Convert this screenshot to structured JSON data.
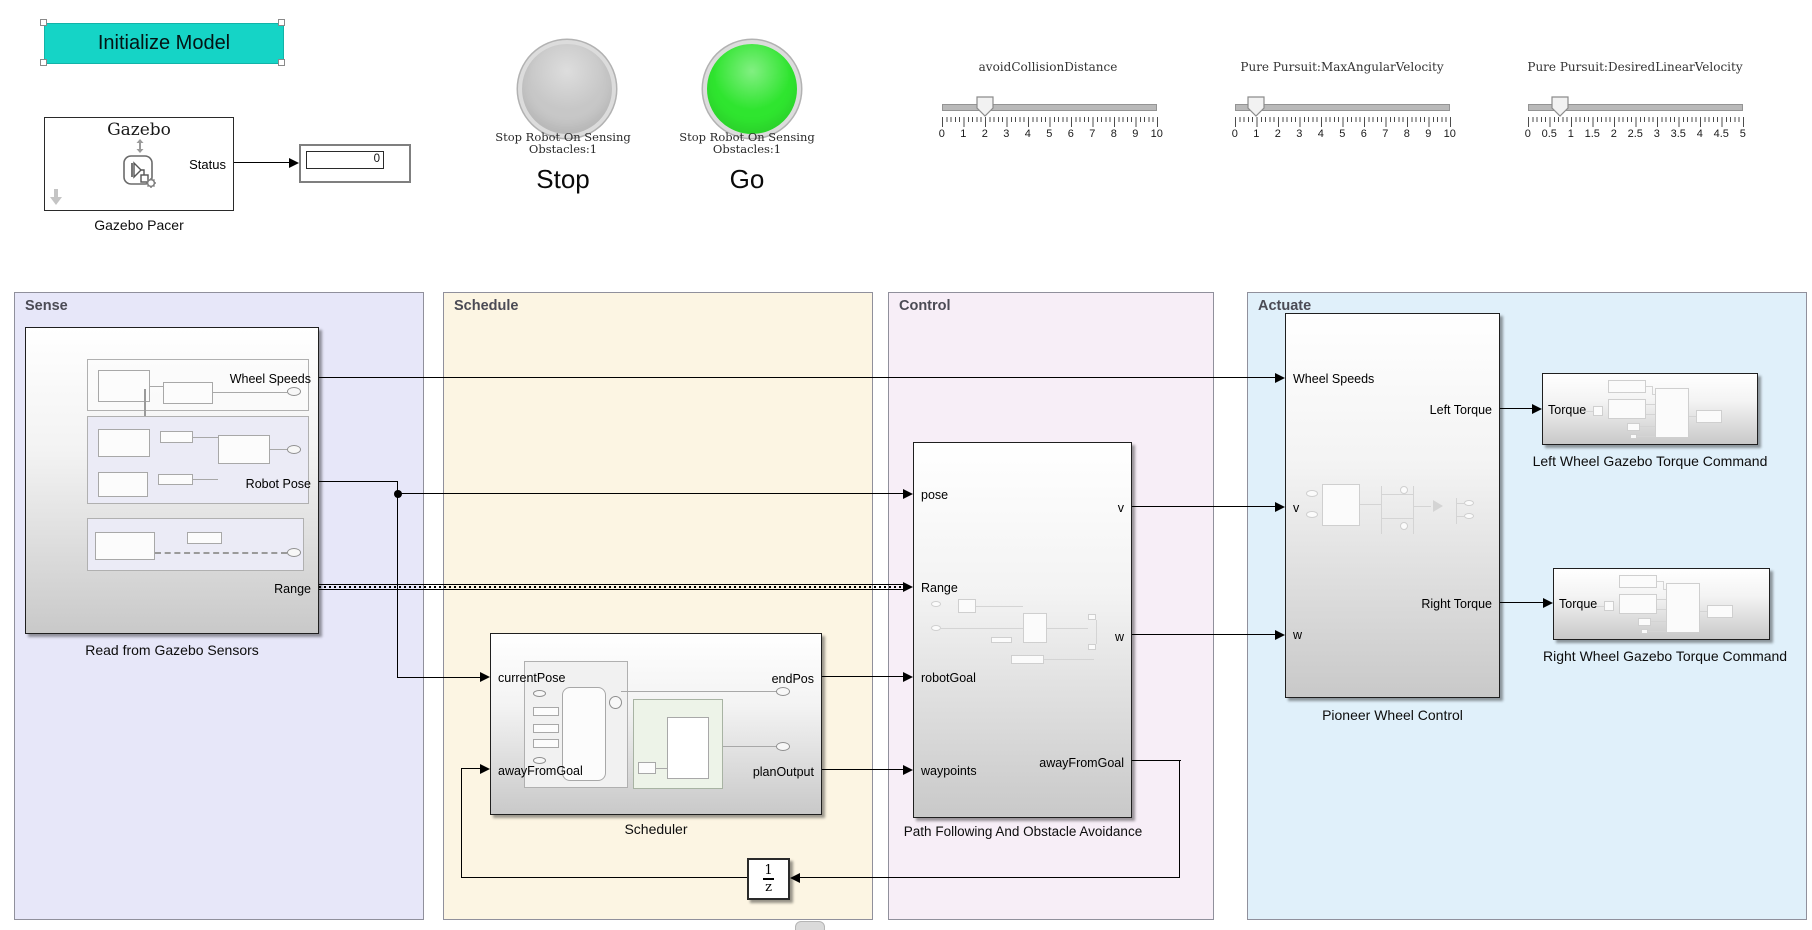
{
  "colors": {
    "init_button": "#15d4c6",
    "lamp_stop": "#c7c7c7",
    "lamp_go": "#2fe52f",
    "sense_bg": "#e7e7f9",
    "schedule_bg": "#fcf5e3",
    "control_bg": "#f7eef7",
    "actuate_bg": "#e0f0fa"
  },
  "toolbar": {
    "init_button_label": "Initialize Model"
  },
  "gazebo_pacer": {
    "title": "Gazebo",
    "status_port": "Status",
    "label": "Gazebo Pacer",
    "display_value": "0"
  },
  "lamps": {
    "stop": {
      "caption_line1": "Stop Robot On Sensing",
      "caption_line2": "Obstacles:1",
      "title": "Stop"
    },
    "go": {
      "caption_line1": "Stop Robot On Sensing",
      "caption_line2": "Obstacles:1",
      "title": "Go"
    }
  },
  "sliders": [
    {
      "label": "avoidCollisionDistance",
      "min": 0,
      "max": 10,
      "value": 2,
      "ticks": [
        "0",
        "1",
        "2",
        "3",
        "4",
        "5",
        "6",
        "7",
        "8",
        "9",
        "10"
      ]
    },
    {
      "label": "Pure Pursuit:MaxAngularVelocity",
      "min": 0,
      "max": 10,
      "value": 1,
      "ticks": [
        "0",
        "1",
        "2",
        "3",
        "4",
        "5",
        "6",
        "7",
        "8",
        "9",
        "10"
      ]
    },
    {
      "label": "Pure Pursuit:DesiredLinearVelocity",
      "min": 0,
      "max": 5,
      "value": 0.75,
      "ticks": [
        "0",
        "0.5",
        "1",
        "1.5",
        "2",
        "2.5",
        "3",
        "3.5",
        "4",
        "4.5",
        "5"
      ]
    }
  ],
  "areas": {
    "sense": {
      "label": "Sense",
      "block": {
        "label": "Read from Gazebo Sensors",
        "out_ports": [
          "Wheel Speeds",
          "Robot Pose",
          "Range"
        ]
      }
    },
    "schedule": {
      "label": "Schedule",
      "block": {
        "label": "Scheduler",
        "in_ports": [
          "currentPose",
          "awayFromGoal"
        ],
        "out_ports": [
          "endPos",
          "planOutput"
        ]
      }
    },
    "control": {
      "label": "Control",
      "block": {
        "label": "Path Following And Obstacle Avoidance",
        "in_ports": [
          "pose",
          "Range",
          "robotGoal",
          "waypoints"
        ],
        "out_ports": [
          "v",
          "w",
          "awayFromGoal"
        ]
      }
    },
    "actuate": {
      "label": "Actuate",
      "block": {
        "label": "Pioneer Wheel Control",
        "in_ports": [
          "Wheel Speeds",
          "v",
          "w"
        ],
        "out_ports": [
          "Left Torque",
          "Right Torque"
        ]
      },
      "left_wheel": {
        "label": "Left Wheel Gazebo Torque Command",
        "in_port": "Torque"
      },
      "right_wheel": {
        "label": "Right Wheel Gazebo Torque Command",
        "in_port": "Torque"
      }
    }
  },
  "unit_delay": {
    "numerator": "1",
    "denominator": "z"
  }
}
